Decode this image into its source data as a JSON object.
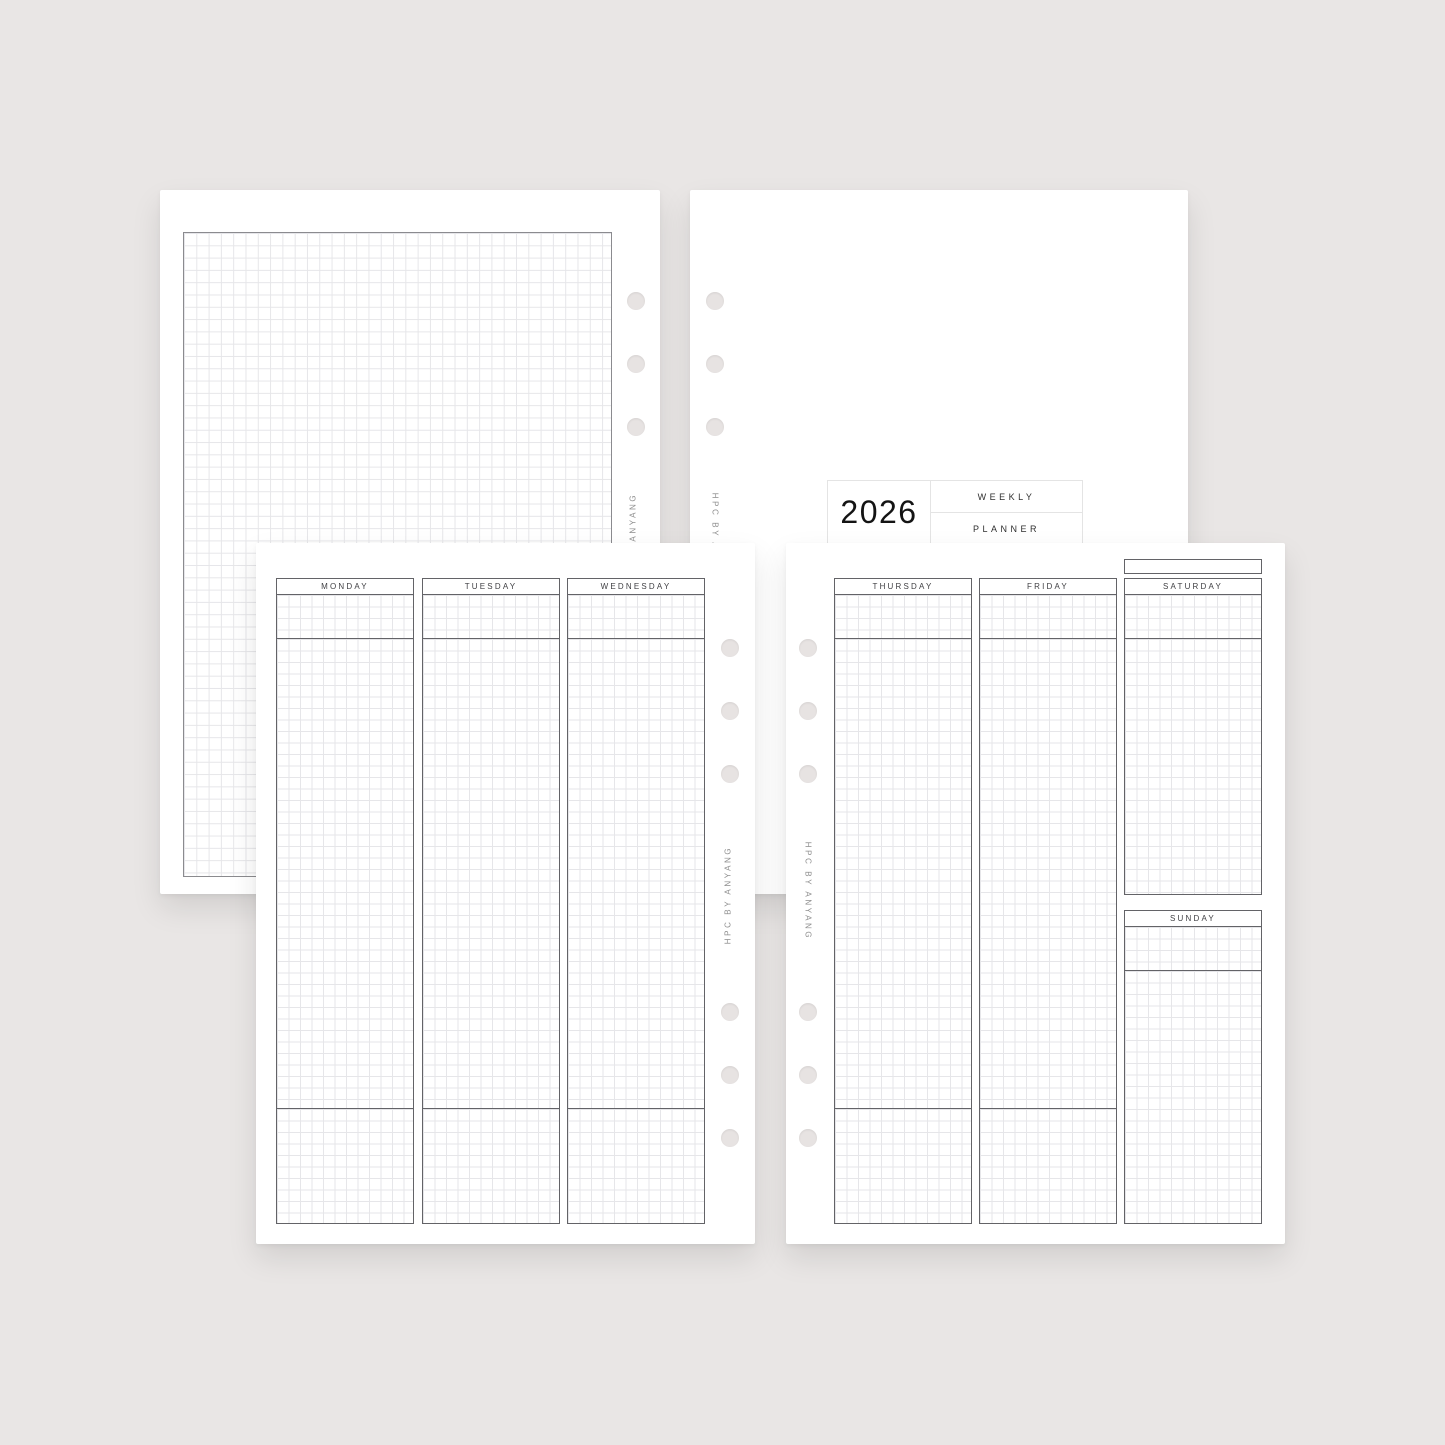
{
  "brand": "HPC BY ANYANG",
  "cover": {
    "year": "2026",
    "title_line1": "WEEKLY",
    "title_line2": "PLANNER"
  },
  "week_left": {
    "days": [
      "MONDAY",
      "TUESDAY",
      "WEDNESDAY"
    ]
  },
  "week_right": {
    "days": [
      "THURSDAY",
      "FRIDAY",
      "SATURDAY",
      "SUNDAY"
    ],
    "week_box_label": ""
  },
  "colors": {
    "background": "#e9e6e5",
    "page": "#ffffff",
    "column_border": "#636367",
    "grid_line": "#e6e6e9",
    "grid_page_border": "#8b8b8f",
    "hole": "#e7e3e2",
    "title_border": "#e4e4e4",
    "year_text": "#141414",
    "day_text": "#404044",
    "brand_text": "#8d8d8d"
  }
}
